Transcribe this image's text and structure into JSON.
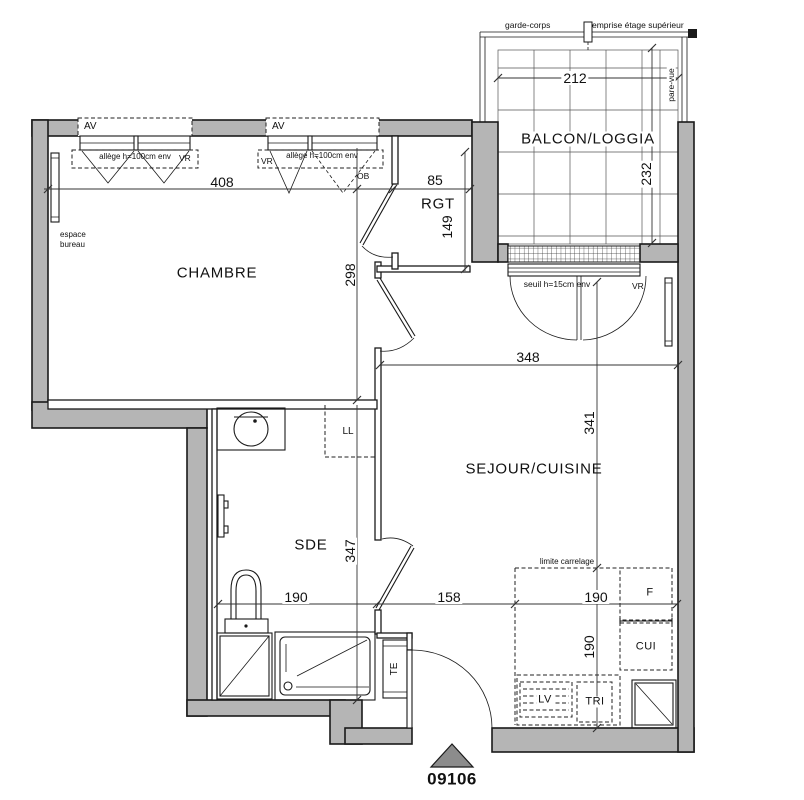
{
  "rooms": {
    "chambre": "CHAMBRE",
    "rgt": "RGT",
    "sde": "SDE",
    "sejour": "SEJOUR/CUISINE",
    "balcon": "BALCON/LOGGIA"
  },
  "labels": {
    "garde_corps": "garde-corps",
    "emprise": "emprise étage supérieur",
    "pare_vue": "pare-vue",
    "av": "AV",
    "allege": "allège h=100cm env",
    "vr": "VR",
    "ob": "OB",
    "espace_line1": "espace",
    "espace_line2": "bureau",
    "seuil": "seuil h=15cm env",
    "limite_carrelage": "limite carrelage",
    "ll": "LL",
    "te": "TE",
    "f": "F",
    "cui": "CUI",
    "lv": "LV",
    "tri": "TRI"
  },
  "dimensions": {
    "chambre_width": "408",
    "chambre_height": "298",
    "rgt_width": "85",
    "rgt_height": "149",
    "balcon_width": "212",
    "balcon_height": "232",
    "sejour_width": "348",
    "sejour_height": "341",
    "sde_width": "190",
    "sde_height": "347",
    "hall_width": "158",
    "kitchen_width": "190",
    "kitchen_height": "190"
  },
  "marker": {
    "lot_number": "09106"
  },
  "colors": {
    "wall_fill": "#b5b5b5",
    "line": "#1a1a1a",
    "triangle_fill": "#8c8c8c",
    "background": "#ffffff"
  }
}
